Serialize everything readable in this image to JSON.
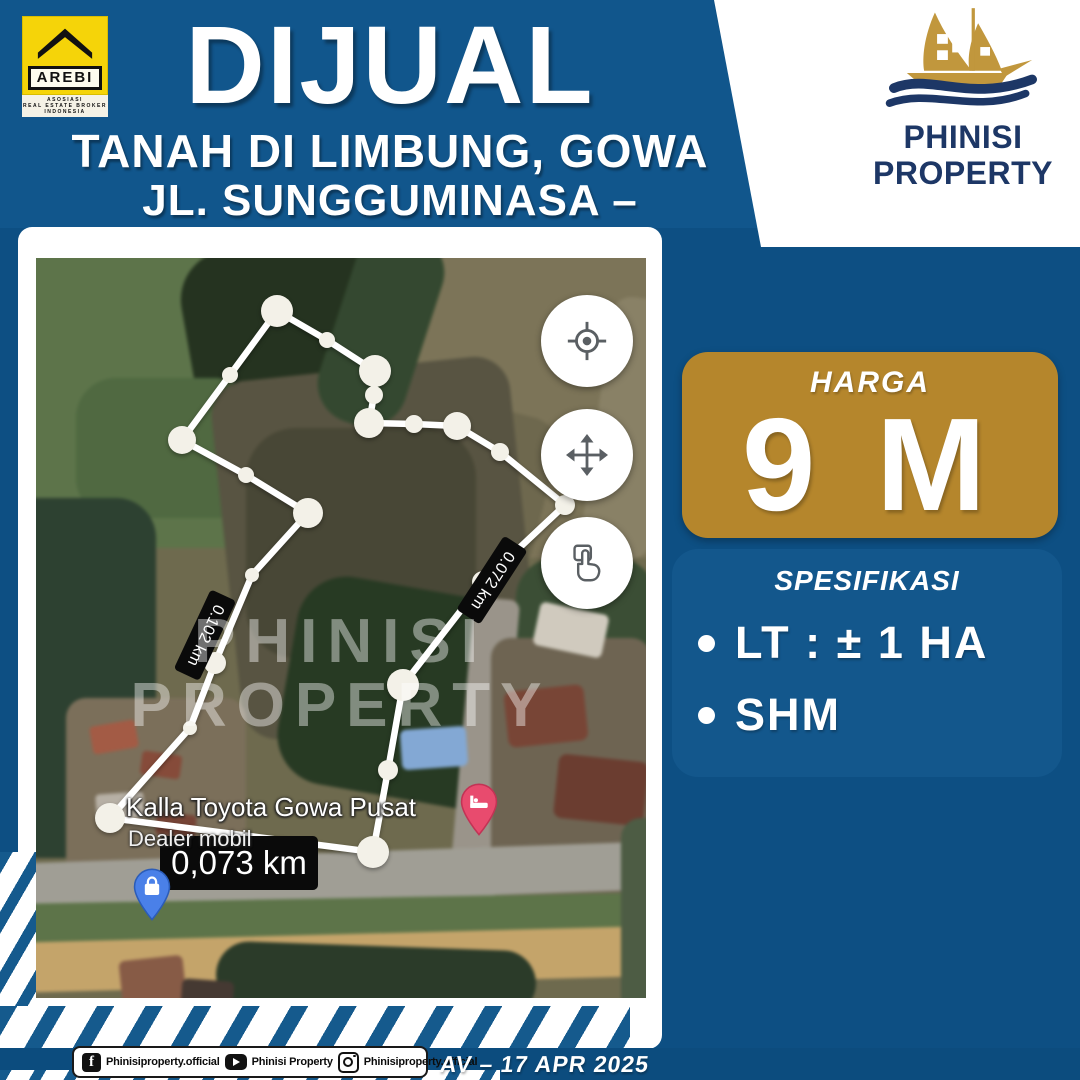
{
  "colors": {
    "page_blue": "#0d4f83",
    "header_blue": "#11568c",
    "spec_panel_blue": "#13578c",
    "price_gold": "#b5862c",
    "arebi_yellow": "#f5d409",
    "brand_navy": "#1d3766",
    "pin_pink": "#e84b6e",
    "pin_blue": "#4a80e8",
    "stripe_blue": "#155a8d"
  },
  "header": {
    "title": "DIJUAL",
    "subtitle_line1": "TANAH DI LIMBUNG, GOWA",
    "subtitle_line2": "JL. SUNGGUMINASA – TAKALAR"
  },
  "arebi_logo": {
    "name": "AREBI",
    "line1": "ASOSIASI",
    "line2": "REAL ESTATE BROKER",
    "line3": "INDONESIA"
  },
  "brand_logo": {
    "line1": "PHINISI",
    "line2": "PROPERTY"
  },
  "price": {
    "label": "HARGA",
    "value": "9 M"
  },
  "specs": {
    "title": "SPESIFIKASI",
    "items": [
      {
        "label": "LT : ± 1 HA"
      },
      {
        "label": "SHM"
      }
    ]
  },
  "map": {
    "place_name": "Kalla Toyota Gowa Pusat",
    "place_type": "Dealer mobil",
    "distance_left": "0.102 km",
    "distance_right": "0.072 km",
    "distance_bottom": "0,073 km",
    "watermark_line1": "PHINISI",
    "watermark_line2": "PROPERTY",
    "controls": [
      {
        "name": "locate"
      },
      {
        "name": "pan"
      },
      {
        "name": "tap"
      }
    ]
  },
  "footer": {
    "facebook": "Phinisiproperty.official",
    "youtube": "Phinisi Property",
    "instagram": "Phinisiproperty.official",
    "date": "AV – 17 APR 2025"
  }
}
